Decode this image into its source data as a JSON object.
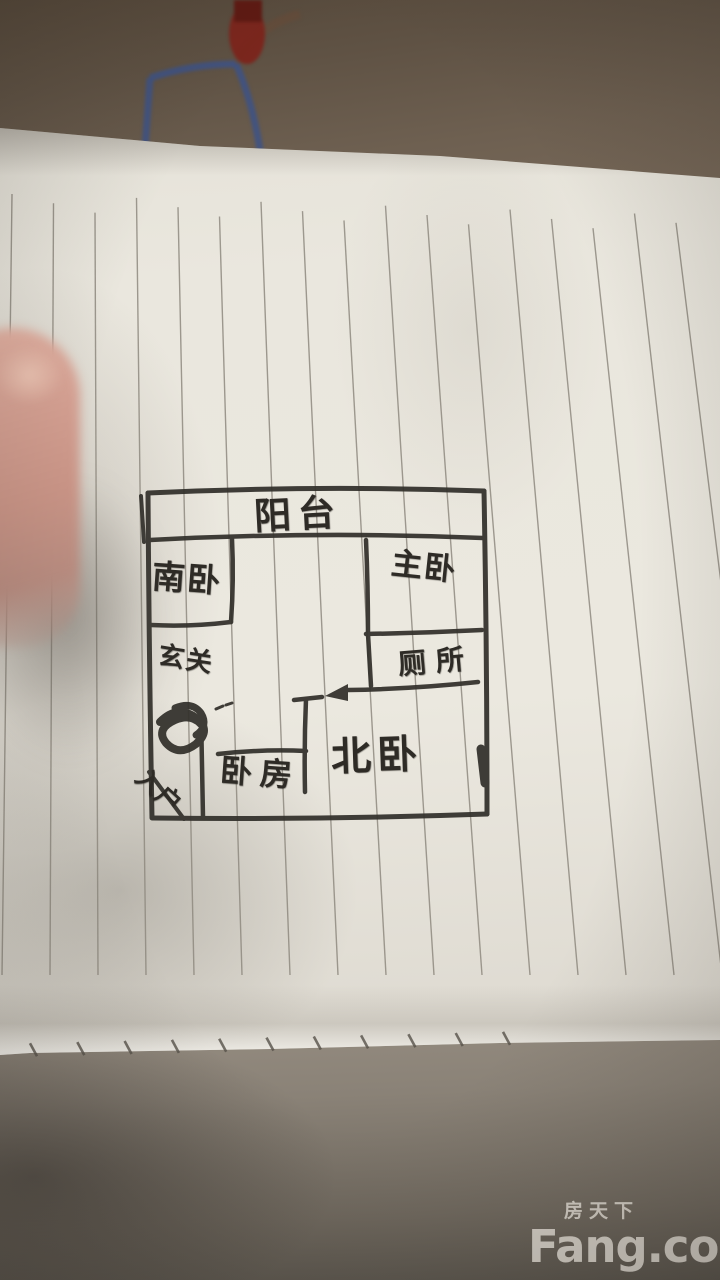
{
  "floor_plan": {
    "rooms": [
      {
        "id": "balcony",
        "label": "阳台"
      },
      {
        "id": "south-bedroom",
        "label": "南卧"
      },
      {
        "id": "master-bedroom",
        "label": "主卧"
      },
      {
        "id": "toilet",
        "label": "厕所"
      },
      {
        "id": "entryway",
        "label": "玄关"
      },
      {
        "id": "bedroom",
        "label": "卧房"
      },
      {
        "id": "north-bedroom",
        "label": "北卧"
      },
      {
        "id": "entry-door",
        "label": "入户"
      }
    ]
  },
  "watermark": {
    "brand_cn": "房天下",
    "brand_en": "Fang.com"
  },
  "colors": {
    "ink": "#32302b",
    "paper": "#eae7de",
    "rule_line": "#8f8a80",
    "background_top": "#6e6051",
    "surface_bottom": "#7c766c",
    "clip_blue": "#3d5286",
    "clip_red": "#7c241b",
    "watermark": "#e4dfd7"
  }
}
